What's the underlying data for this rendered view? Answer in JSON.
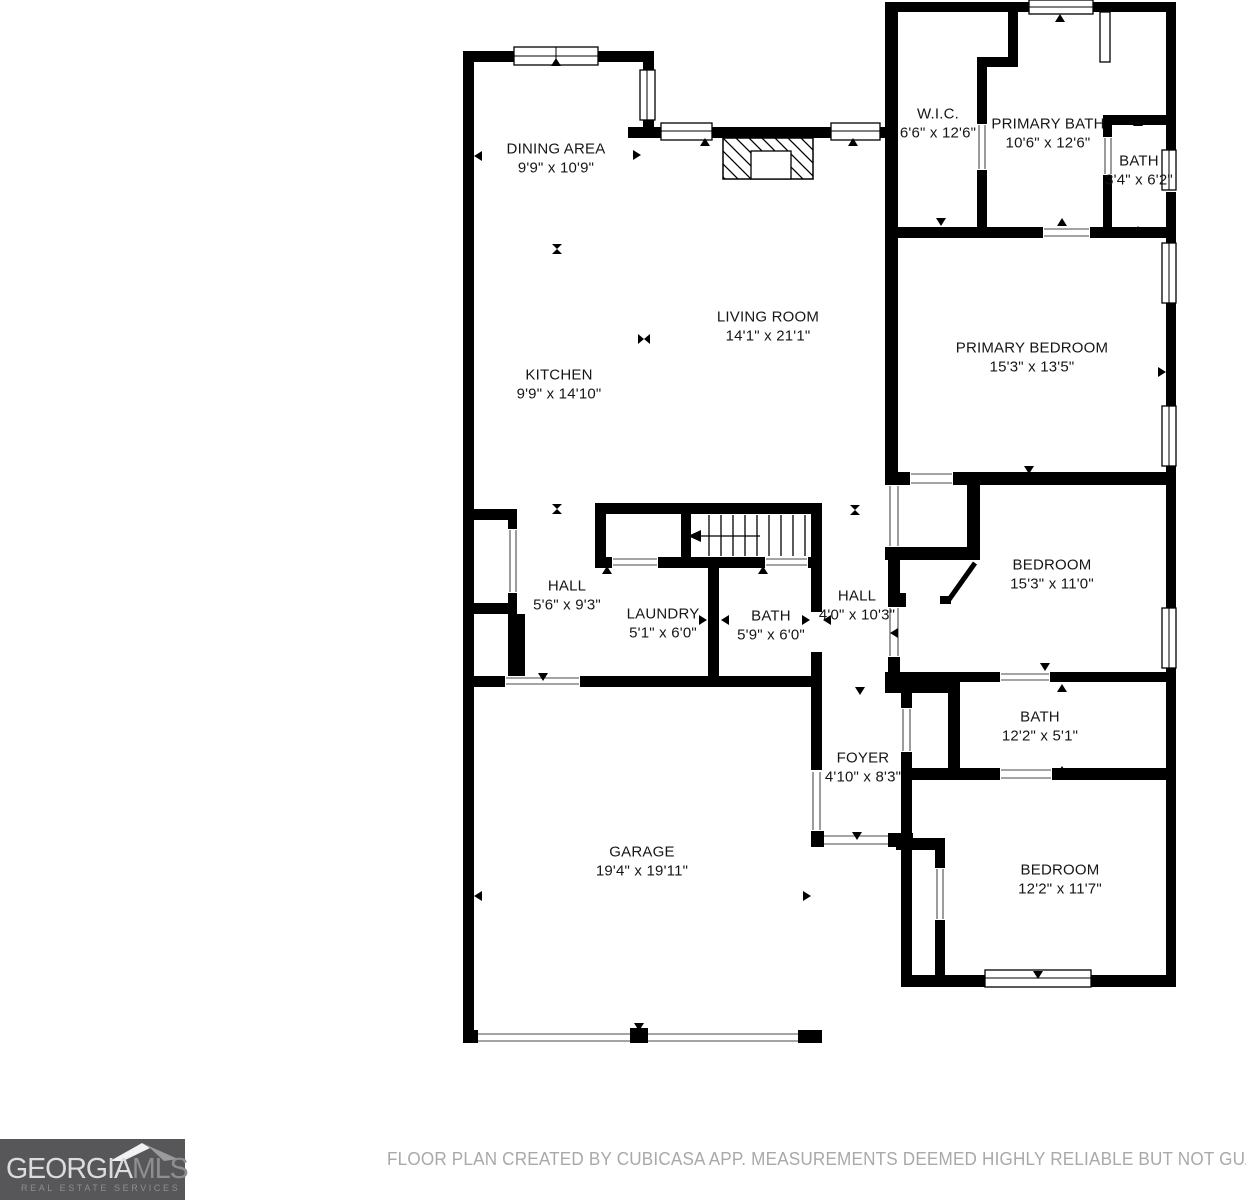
{
  "floorplan": {
    "rooms": [
      {
        "name": "DINING AREA",
        "dims": "9'9\" x 10'9\""
      },
      {
        "name": "KITCHEN",
        "dims": "9'9\" x 14'10\""
      },
      {
        "name": "LIVING ROOM",
        "dims": "14'1\" x 21'1\""
      },
      {
        "name": "W.I.C.",
        "dims": "6'6\" x 12'6\""
      },
      {
        "name": "PRIMARY BATH",
        "dims": "10'6\" x 12'6\""
      },
      {
        "name": "BATH",
        "dims": "3'4\" x 6'2\""
      },
      {
        "name": "PRIMARY BEDROOM",
        "dims": "15'3\" x 13'5\""
      },
      {
        "name": "BEDROOM",
        "dims": "15'3\" x 11'0\""
      },
      {
        "name": "HALL",
        "dims": "5'6\" x 9'3\""
      },
      {
        "name": "LAUNDRY",
        "dims": "5'1\" x 6'0\""
      },
      {
        "name": "BATH",
        "dims": "5'9\" x 6'0\""
      },
      {
        "name": "HALL",
        "dims": "4'0\" x 10'3\""
      },
      {
        "name": "BATH",
        "dims": "12'2\" x 5'1\""
      },
      {
        "name": "FOYER",
        "dims": "4'10\" x 8'3\""
      },
      {
        "name": "GARAGE",
        "dims": "19'4\" x 19'11\""
      },
      {
        "name": "BEDROOM",
        "dims": "12'2\" x 11'7\""
      }
    ],
    "symbols": [
      "stairs-icon",
      "fireplace-icon",
      "window-symbol",
      "door-opening-symbol",
      "direction-arrow"
    ]
  },
  "logo": {
    "brand_primary": "GEORGIA",
    "brand_secondary": "MLS",
    "tagline": "REAL ESTATE SERVICES"
  },
  "footer": {
    "disclaimer": "FLOOR PLAN CREATED BY CUBICASA APP. MEASUREMENTS DEEMED HIGHLY RELIABLE BUT NOT GUARANTEED."
  },
  "colors": {
    "wall": "#000000",
    "background": "#ffffff",
    "logo_background": "#57575a",
    "logo_primary_text": "#dcdcdd",
    "logo_secondary_text": "#8e8e92",
    "disclaimer_text": "#a9a9a9",
    "room_text": "#161616"
  }
}
